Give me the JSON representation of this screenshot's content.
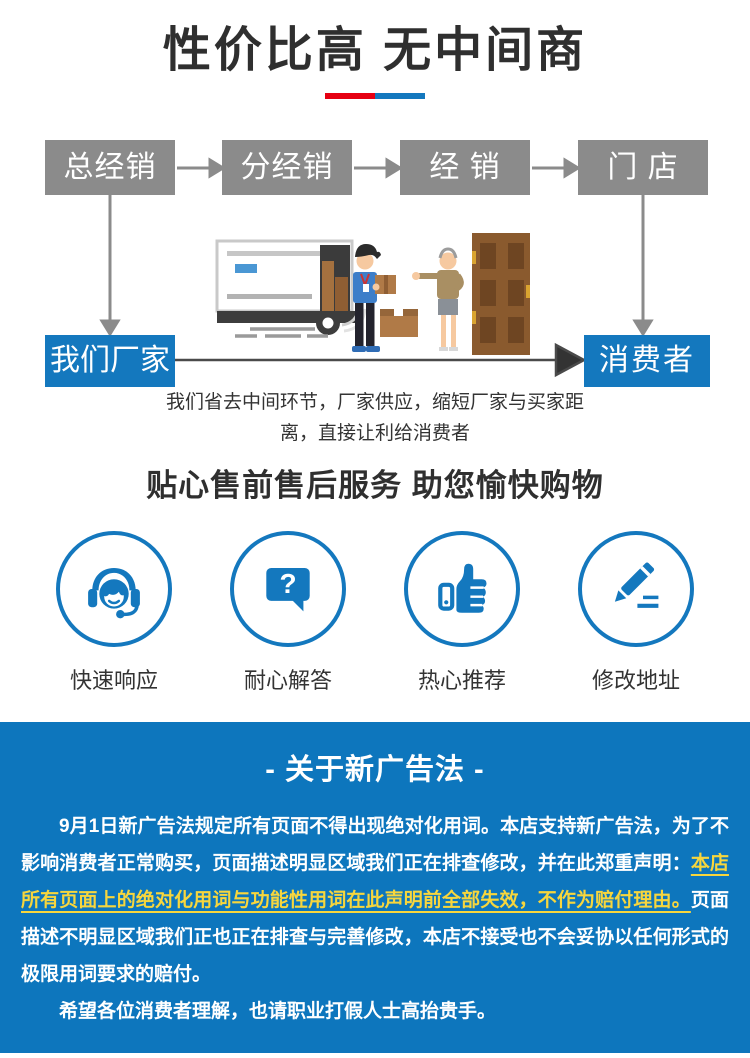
{
  "header": {
    "title": "性价比高 无中间商",
    "bar_colors": {
      "red": "#e60012",
      "blue": "#1478be"
    }
  },
  "flow": {
    "boxes": [
      {
        "label": "总经销"
      },
      {
        "label": "分经销"
      },
      {
        "label": "经 销"
      },
      {
        "label": "门 店"
      }
    ],
    "factory_label": "我们厂家",
    "consumer_label": "消费者",
    "caption_line1": "我们省去中间环节，厂家供应，缩短厂家与买家距",
    "caption_line2": "离，直接让利给消费者",
    "box_color": "#8b8b8b",
    "accent_color": "#1478be"
  },
  "services": {
    "title": "贴心售前售后服务 助您愉快购物",
    "qmark": "?",
    "items": [
      {
        "label": "快速响应",
        "icon": "headset-icon"
      },
      {
        "label": "耐心解答",
        "icon": "question-bubble-icon"
      },
      {
        "label": "热心推荐",
        "icon": "thumbs-up-icon"
      },
      {
        "label": "修改地址",
        "icon": "pencil-edit-icon"
      }
    ]
  },
  "notice": {
    "title": "- 关于新广告法 -",
    "p1_part1": "9月1日新广告法规定所有页面不得出现绝对化用词。本店支持新广告法，为了不影响消费者正常购买，页面描述明显区域我们正在排查修改，并在此郑重声明：",
    "p1_highlight": "本店所有页面上的绝对化用词与功能性用词在此声明前全部失效，不作为赔付理由。",
    "p1_part2": "页面描述不明显区域我们正也正在排查与完善修改，本店不接受也不会妥协以任何形式的极限用词要求的赔付。",
    "p2": "希望各位消费者理解，也请职业打假人士高抬贵手。",
    "colors": {
      "background": "#0d76bd",
      "highlight": "#f7d63d"
    }
  }
}
